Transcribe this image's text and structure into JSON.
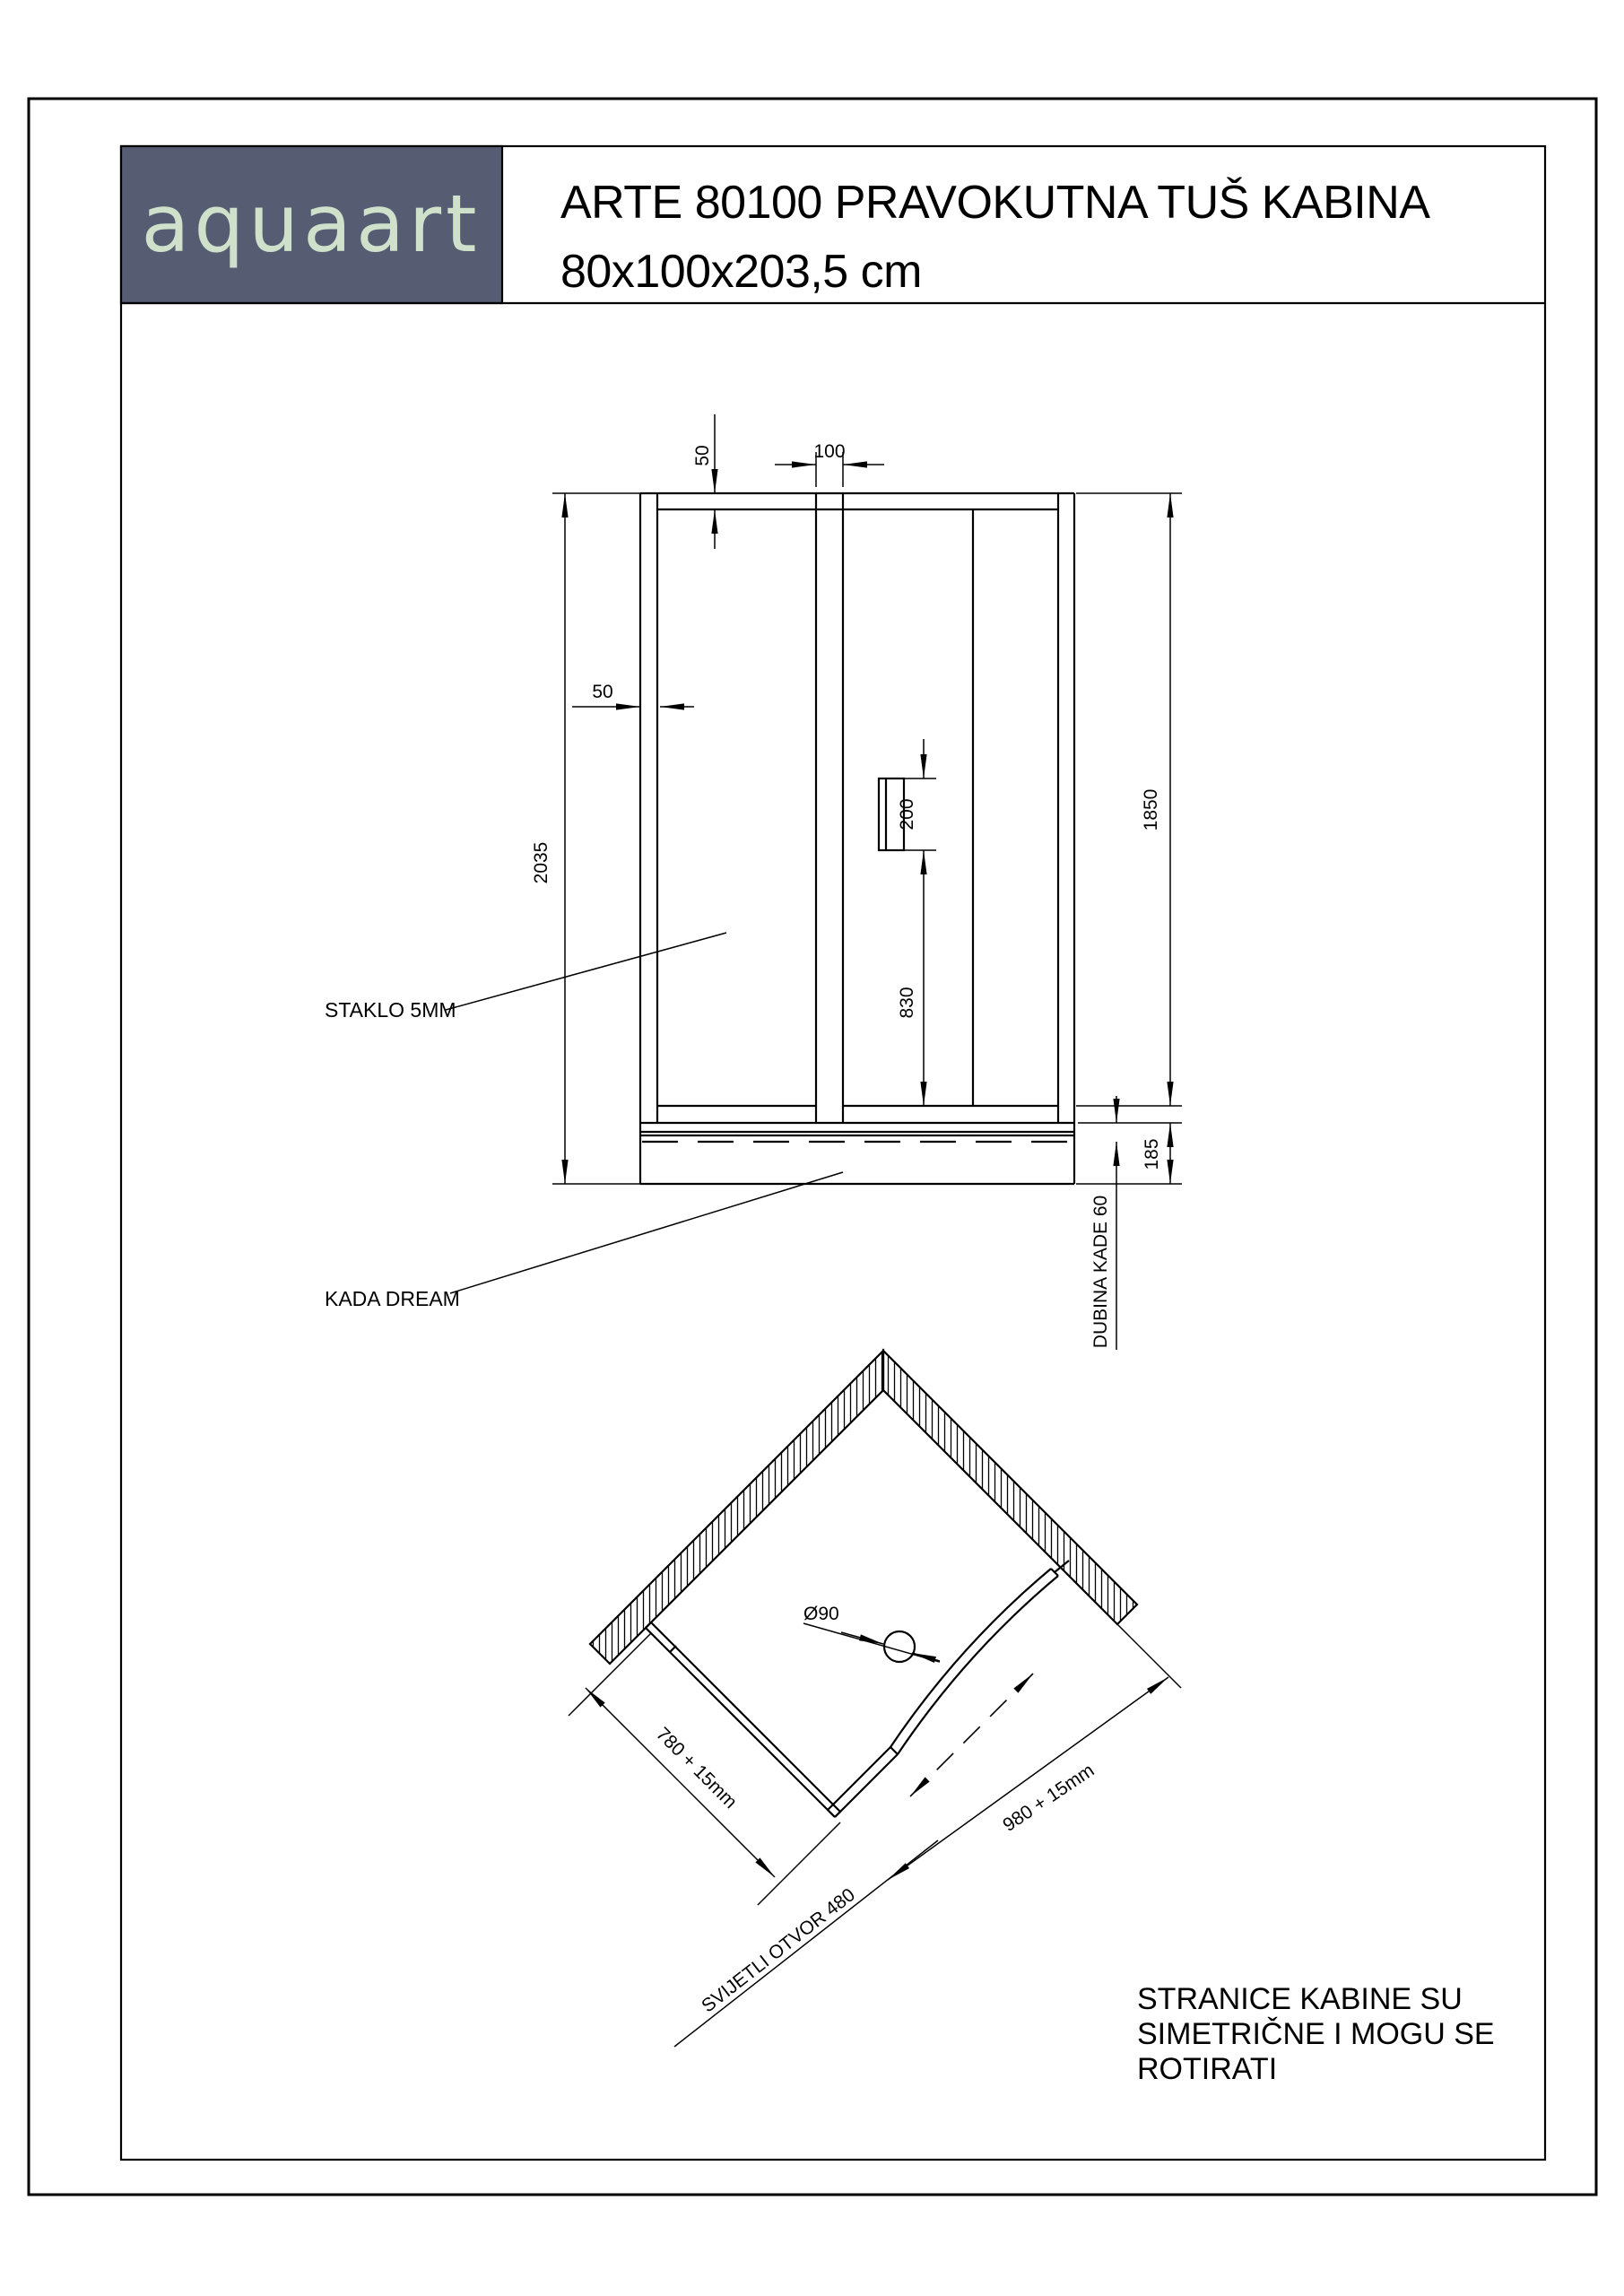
{
  "page": {
    "background": "#ffffff",
    "ink": "#000000"
  },
  "header": {
    "logo_text": "aquaart",
    "logo_bg": "#565d73",
    "logo_fg": "#cfe1ca",
    "title_line1": "ARTE 80100 PRAVOKUTNA TUŠ KABINA",
    "title_line2": "80x100x203,5 cm"
  },
  "front_view": {
    "dim_frame_top": "50",
    "dim_mullion_width": "100",
    "dim_profile_width": "50",
    "dim_total_height": "2035",
    "dim_glass_height": "1850",
    "dim_handle_length": "200",
    "dim_handle_from_bottom": "830",
    "dim_tray_height": "185",
    "label_glass": "STAKLO 5MM",
    "label_tray": "KADA DREAM",
    "label_tray_depth": "DUBINA KADE 60"
  },
  "plan_view": {
    "label_drain": "Ø90",
    "dim_side_short": "780 + 15mm",
    "dim_side_long": "980 + 15mm",
    "label_opening": "SVIJETLI OTVOR 480"
  },
  "note": {
    "line1": "STRANICE KABINE SU",
    "line2": "SIMETRIČNE I MOGU SE",
    "line3": "ROTIRATI"
  }
}
